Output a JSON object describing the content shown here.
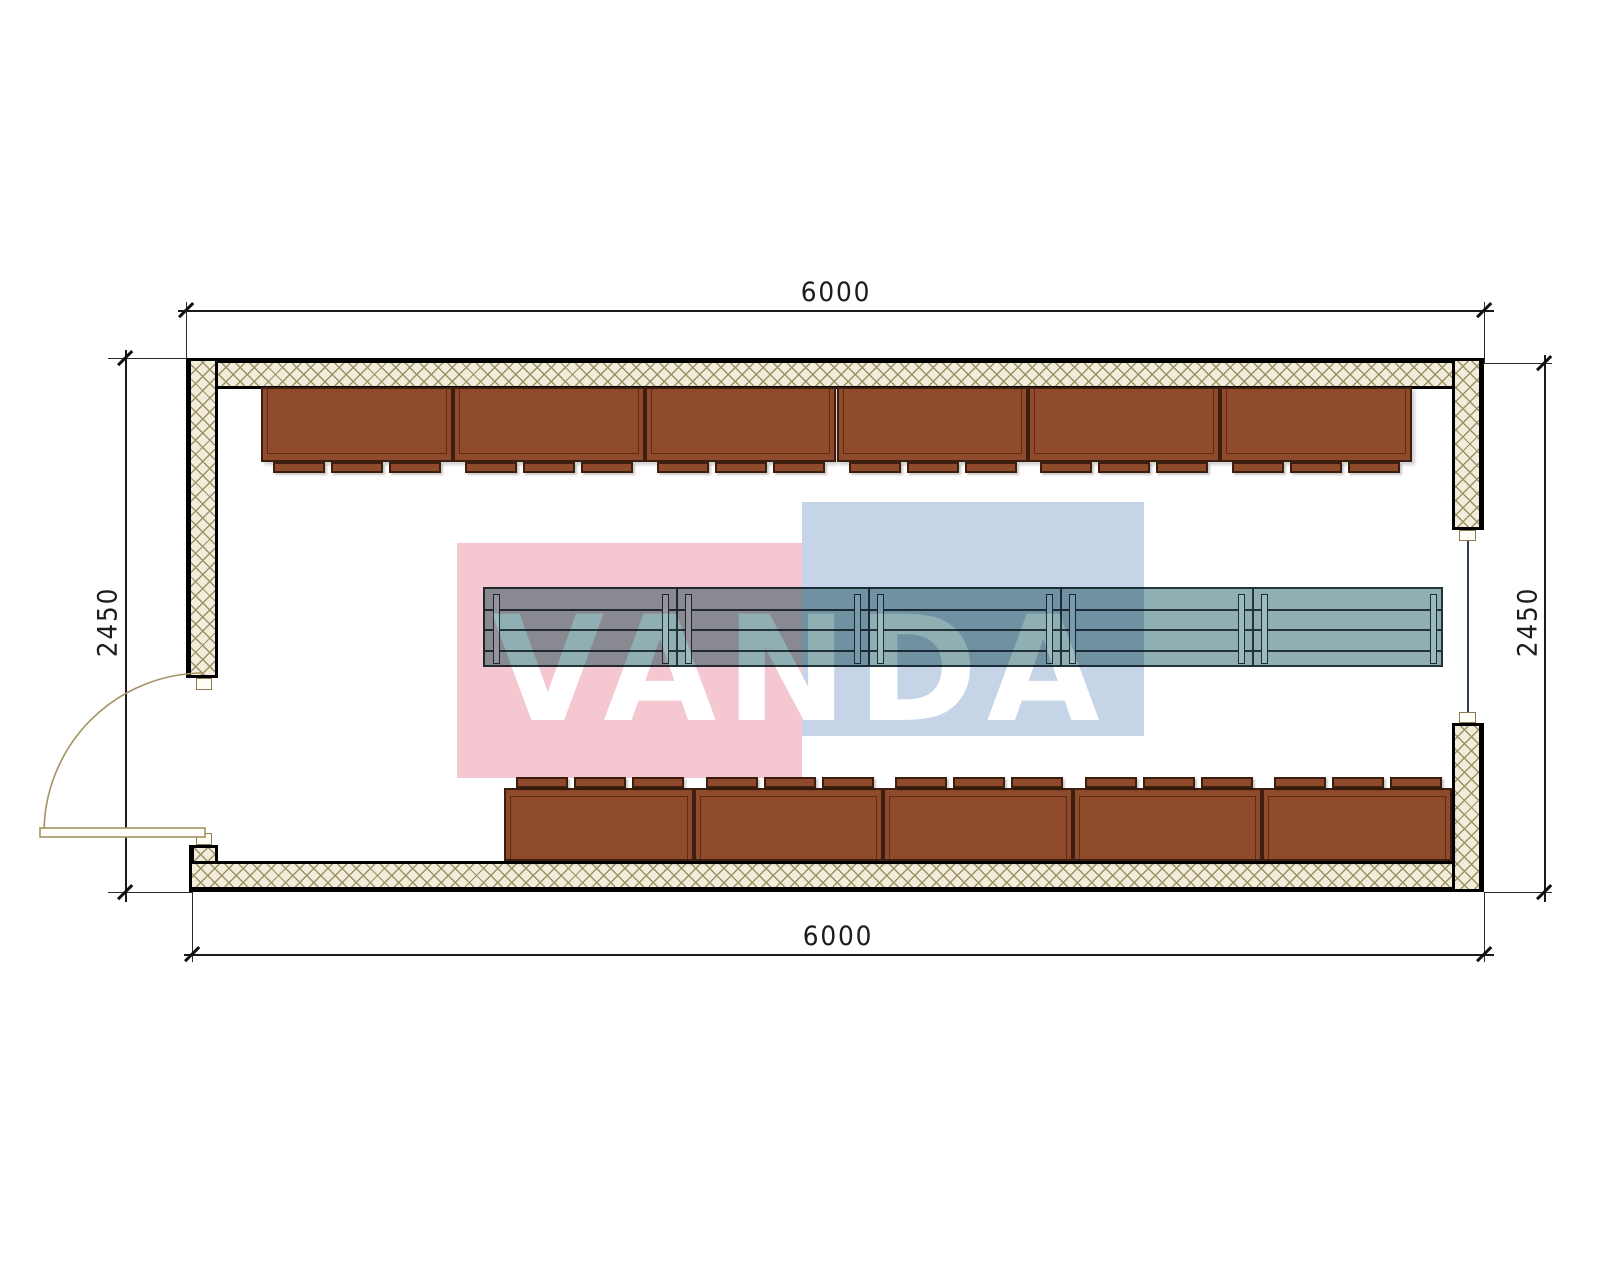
{
  "drawing": {
    "type": "floor-plan",
    "dimensions": {
      "top": "6000",
      "bottom": "6000",
      "left": "2450",
      "right": "2450"
    },
    "watermark": {
      "text": "VANDA",
      "pink": "#f5c8d1",
      "blue": "#c5d4e7"
    },
    "furniture": {
      "top_cabinet_count": 6,
      "bottom_cabinet_count": 5,
      "tabs_per_cabinet": 3,
      "table_segment_count": 5
    },
    "colors": {
      "cabinet_brown": "#8e4a2b",
      "cabinet_outline": "#3c1f0e",
      "table_teal": "#8fafb2",
      "table_outline": "#22333a",
      "wall_fill": "#f2ecda",
      "wall_hatch": "#9c9164",
      "door_line": "#a39362",
      "window_line": "#2e3c55",
      "dimension_line": "#1a1a1a"
    }
  }
}
